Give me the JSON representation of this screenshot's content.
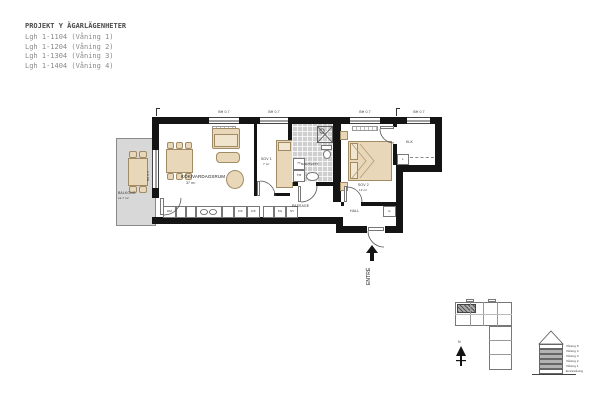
{
  "title_block": {
    "title": "PROJEKT Y ÄGARLÄGENHETER",
    "units": [
      "Lgh 1-1104 (Våning 1)",
      "Lgh 1-1204 (Våning 2)",
      "Lgh 1-1304 (Våning 3)",
      "Lgh 1-1404 (Våning 4)"
    ]
  },
  "plan": {
    "rooms": {
      "livingroom": {
        "name": "KÖK/VARDAGSRUM",
        "area": "37 m²"
      },
      "bedroom1": {
        "name": "SOV 1",
        "area": "7 m²"
      },
      "bathroom": {
        "name": "BAD/TVÄTT"
      },
      "bedroom2": {
        "name": "SOV 2",
        "area": "12 m²"
      },
      "closet": {
        "name": "KLK"
      },
      "hall": {
        "name": "HALL"
      },
      "passage": {
        "name": "PASSAGE"
      },
      "balcony": {
        "name": "BALKONG",
        "area": "ca 7 m²"
      }
    },
    "entrance_label": "ENTRÉ",
    "window_labels": [
      "BH 0.7",
      "BH 0.7",
      "BH 0.7",
      "BH 0.7"
    ],
    "balcony_glass_label": "BH 0.4",
    "appliances": {
      "dm": "DM",
      "kf1": "K/F",
      "kf2": "K/F",
      "sg": "SG",
      "st": "ST",
      "tt": "TT",
      "tm": "TM"
    },
    "cabinets": {
      "linen": "L",
      "wardrobe": "G"
    }
  },
  "site_plan": {
    "north_label": "N"
  },
  "stack_diagram": {
    "floors": [
      {
        "label": "Våning 5",
        "highlighted": false
      },
      {
        "label": "Våning 4",
        "highlighted": true
      },
      {
        "label": "Våning 3",
        "highlighted": true
      },
      {
        "label": "Våning 2",
        "highlighted": true
      },
      {
        "label": "Våning 1",
        "highlighted": true
      },
      {
        "label": "Entrévåning",
        "highlighted": false
      }
    ]
  },
  "colors": {
    "wall": "#141414",
    "furniture": "#e8d7b8",
    "balcony": "#d8d8d8",
    "tile": "#cfcfcf"
  }
}
